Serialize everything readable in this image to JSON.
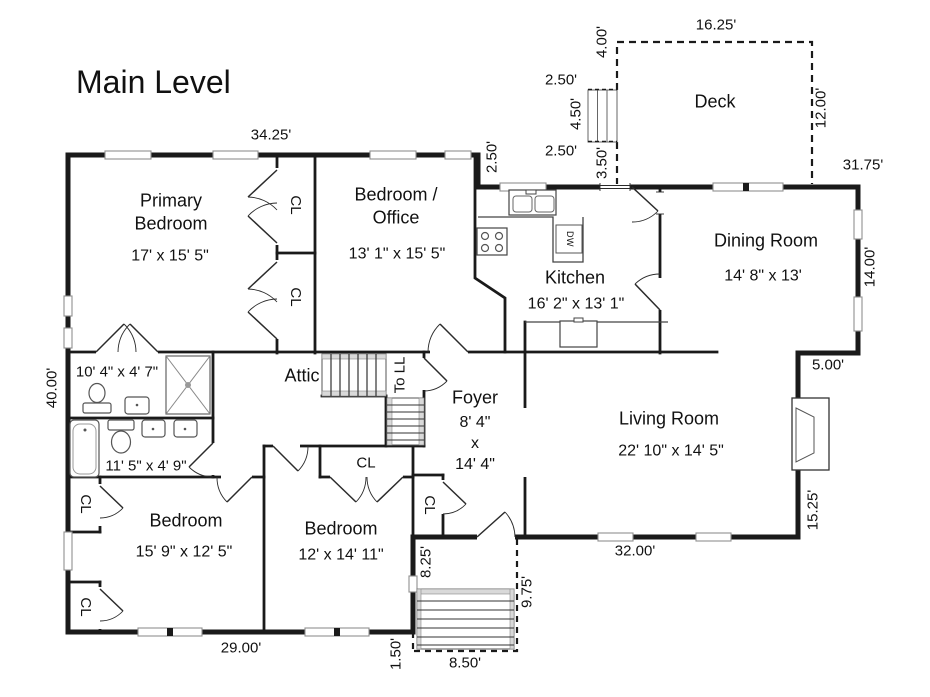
{
  "title": "Main Level",
  "colors": {
    "wall": "#1a1a1a",
    "fixture": "#555555",
    "stair_fill": "#d9d9d9",
    "background": "#ffffff"
  },
  "rooms": {
    "primary": {
      "name": "Primary\nBedroom",
      "size": "17' x 15' 5\""
    },
    "office": {
      "name": "Bedroom /\nOffice",
      "size": "13' 1\" x 15' 5\""
    },
    "kitchen": {
      "name": "Kitchen",
      "size": "16' 2\" x 13' 1\""
    },
    "dining": {
      "name": "Dining Room",
      "size": "14' 8\" x 13'"
    },
    "living": {
      "name": "Living Room",
      "size": "22' 10\" x 14' 5\""
    },
    "foyer": {
      "name": "Foyer",
      "size": "8' 4\"\nx\n14' 4\""
    },
    "deck": {
      "name": "Deck"
    },
    "attic": {
      "name": "Attic"
    },
    "stairs_down": {
      "name": "To LL"
    },
    "bath_top": {
      "size": "10' 4\" x 4' 7\""
    },
    "bath_bottom": {
      "size": "11' 5\" x 4' 9\""
    },
    "bedroom_sw": {
      "name": "Bedroom",
      "size": "15' 9\" x 12' 5\""
    },
    "bedroom_se": {
      "name": "Bedroom",
      "size": "12' x 14' 11\""
    },
    "closet": {
      "abbr": "CL"
    },
    "appliances": {
      "dishwasher": "DW"
    }
  },
  "dims": {
    "top_width": "34.25'",
    "kitchen_offset": "2.50'",
    "deck_door_gap": "2.50'",
    "deck_stairs": "4.50'",
    "deck_gap_lower": "2.50'",
    "deck_landing": "3.50'",
    "deck_setback": "4.00'",
    "deck_width": "16.25'",
    "deck_depth": "12.00'",
    "right_width": "31.75'",
    "dining_depth": "14.00'",
    "living_offset": "5.00'",
    "living_depth": "15.25'",
    "living_width": "32.00'",
    "left_depth": "40.00'",
    "bottom_width": "29.00'",
    "porch_wall": "8.25'",
    "porch_depth": "9.75'",
    "porch_offset": "1.50'",
    "porch_width": "8.50'"
  }
}
